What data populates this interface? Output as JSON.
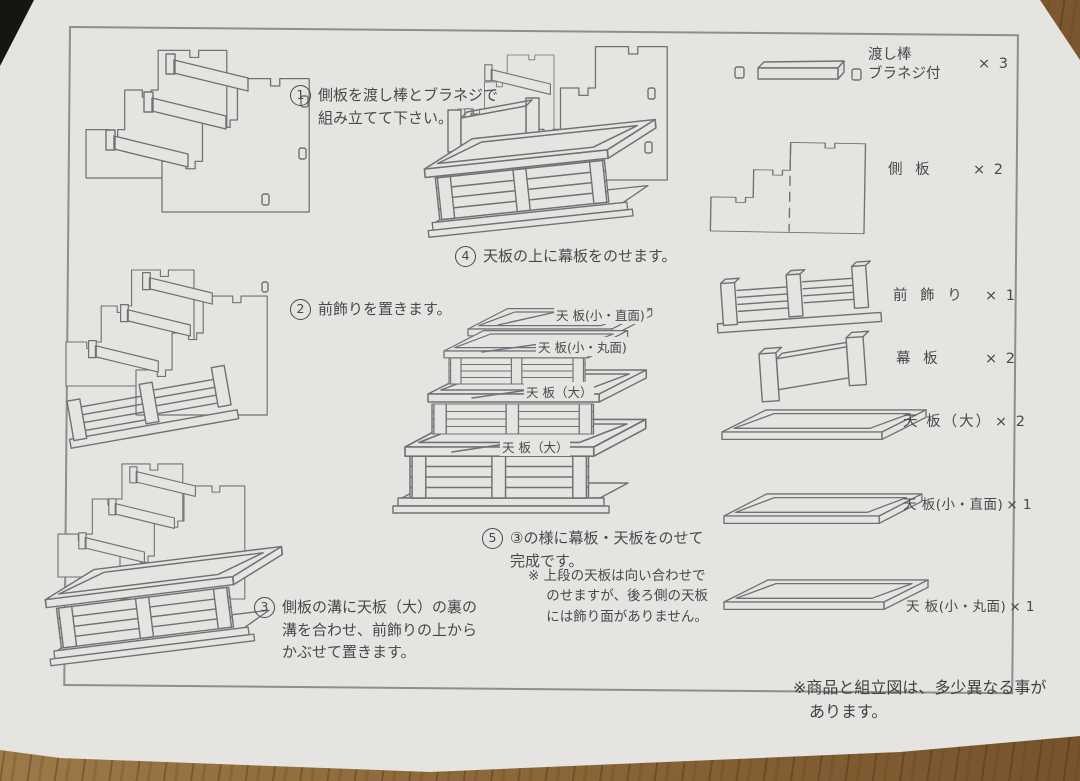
{
  "steps": [
    {
      "num": "1",
      "text": "側板を渡し棒とブラネジで\n組み立てて下さい。"
    },
    {
      "num": "2",
      "text": "前飾りを置きます。"
    },
    {
      "num": "3",
      "text": "側板の溝に天板（大）の裏の\n溝を合わせ、前飾りの上から\nかぶせて置きます。"
    },
    {
      "num": "4",
      "text": "天板の上に幕板をのせます。"
    },
    {
      "num": "5",
      "text": "③の様に幕板・天板をのせて\n完成です。"
    }
  ],
  "step5_note": "※ 上段の天板は向い合わせで\nのせますが、後ろ側の天板\nには飾り面がありません。",
  "diagram_labels": {
    "top_small_straight": "天 板(小・直面)",
    "top_small_round": "天 板(小・丸面)",
    "mid_large": "天 板（大）",
    "bottom_large": "天 板（大）"
  },
  "parts": [
    {
      "name": "渡し棒\nブラネジ付",
      "qty": "× 3"
    },
    {
      "name": "側 板",
      "qty": "× 2"
    },
    {
      "name": "前 飾 り",
      "qty": "× 1"
    },
    {
      "name": "幕 板",
      "qty": "× 2"
    },
    {
      "name": "天 板（大）",
      "qty": "× 2"
    },
    {
      "name": "天 板(小・直面)",
      "qty": "× 1"
    },
    {
      "name": "天 板(小・丸面)",
      "qty": "× 1"
    }
  ],
  "footer_note": "※商品と組立図は、多少異なる事が\nあります。",
  "colors": {
    "paper": "#e6e4e0",
    "ink": "#48484f",
    "line": "#707076",
    "wood": "#8a6336"
  }
}
